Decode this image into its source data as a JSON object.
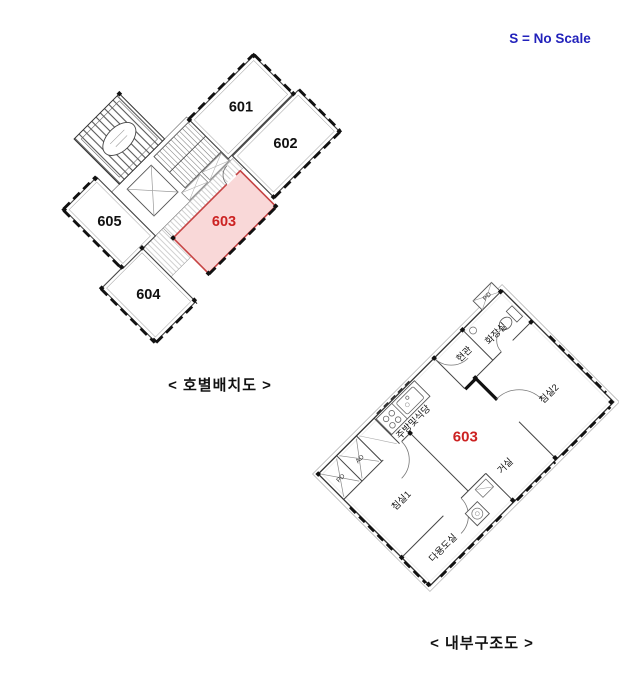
{
  "scale_note": {
    "text": "S = No Scale",
    "color": "#2222bb"
  },
  "unit_layout": {
    "caption": "< 호별배치도 >",
    "units": [
      {
        "label": "601",
        "highlighted": false
      },
      {
        "label": "602",
        "highlighted": false
      },
      {
        "label": "603",
        "highlighted": true
      },
      {
        "label": "604",
        "highlighted": false
      },
      {
        "label": "605",
        "highlighted": false
      }
    ]
  },
  "interior_plan": {
    "caption": "< 내부구조도 >",
    "unit_number": "603",
    "rooms": [
      {
        "label": "현관"
      },
      {
        "label": "화장실"
      },
      {
        "label": "침실2"
      },
      {
        "label": "거실"
      },
      {
        "label": "주방및식당"
      },
      {
        "label": "침실1"
      },
      {
        "label": "다용도실"
      }
    ],
    "ducts": [
      {
        "label": "PD"
      },
      {
        "label": "AD"
      },
      {
        "label": "PD"
      }
    ]
  },
  "colors": {
    "highlight_fill": "#f9d8d8",
    "highlight_stroke": "#c64444",
    "unit_number_red": "#cc2222",
    "scale_note_blue": "#2222bb",
    "wall_line": "#444444",
    "window_band": "#111111"
  }
}
